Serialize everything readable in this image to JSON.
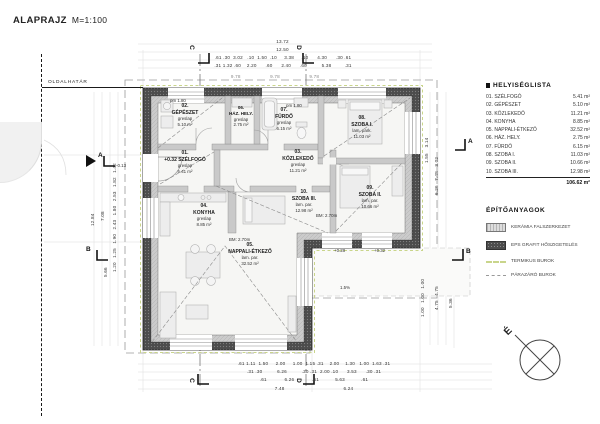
{
  "title": {
    "main": "ALAPRAJZ",
    "scale": "M=1:100"
  },
  "boundary": {
    "label": "OLDALHATÁR"
  },
  "rooms": [
    {
      "num": "01.",
      "level": "+0.32",
      "name": "SZÉLFOGÓ",
      "finish": "greslap",
      "area": "5.41 m²"
    },
    {
      "num": "02.",
      "name": "GÉPÉSZET",
      "finish": "greslap",
      "area": "5.10 m²"
    },
    {
      "num": "03.",
      "name": "KÖZLEKEDŐ",
      "finish": "greslap",
      "area": "11.21 m²"
    },
    {
      "num": "04.",
      "name": "KONYHA",
      "finish": "greslap",
      "area": "8.85 m²"
    },
    {
      "num": "05.",
      "name": "NAPPALI-ÉTKEZŐ",
      "finish": "lam. par.",
      "area": "32.52 m²"
    },
    {
      "num": "06.",
      "name": "HÁZ. HELY.",
      "finish": "greslap",
      "area": "2.75 m²"
    },
    {
      "num": "07.",
      "name": "FÜRDŐ",
      "finish": "greslap",
      "area": "6.15 m²"
    },
    {
      "num": "08.",
      "name": "SZOBA I.",
      "finish": "lam. park.",
      "area": "11.03 m²"
    },
    {
      "num": "09.",
      "name": "SZOBA II.",
      "finish": "lam. par.",
      "area": "10.66 m²"
    },
    {
      "num": "10.",
      "name": "SZOBA III.",
      "finish": "lam. par.",
      "area": "12.98 m²"
    }
  ],
  "room_list": {
    "title": "HELYISÉGLISTA",
    "items": [
      {
        "name": "01. SZÉLFOGÓ",
        "area": "5.41 m²"
      },
      {
        "name": "02. GÉPÉSZET",
        "area": "5.10 m²"
      },
      {
        "name": "03. KÖZLEKEDŐ",
        "area": "11.21 m²"
      },
      {
        "name": "04. KONYHA",
        "area": "8.85 m²"
      },
      {
        "name": "05. NAPPALI-ÉTKEZŐ",
        "area": "32.52 m²"
      },
      {
        "name": "06. HÁZ. HELY.",
        "area": "2.75 m²"
      },
      {
        "name": "07. FÜRDŐ",
        "area": "6.15 m²"
      },
      {
        "name": "08. SZOBA I.",
        "area": "11.03 m²"
      },
      {
        "name": "09. SZOBA II.",
        "area": "10.66 m²"
      },
      {
        "name": "10. SZOBA III.",
        "area": "12.98 m²"
      }
    ],
    "total": "106.62 m²"
  },
  "materials": {
    "title": "ÉPÍTŐANYAGOK",
    "items": [
      {
        "label": "KERÁMIA FALSZERKEZET"
      },
      {
        "label": "EPS GRAFIT HŐSZIGETELÉS"
      },
      {
        "label": "TERMIKUS BUROK"
      },
      {
        "label": "PÁRAZÁRÓ BUROK"
      }
    ]
  },
  "annotations": {
    "pm1": "pm 1.80",
    "pm2": "pm 1.80",
    "bm1": "BM: 2.70m",
    "bm2": "BM: 2.70m",
    "slope": "1.5%",
    "level_terrace1": "+0.28",
    "level_terrace2": "+0.32",
    "level_out": "-0.13"
  },
  "markers": {
    "a": "A",
    "b": "B",
    "c": "C",
    "d": "D"
  },
  "compass": {
    "north": "É"
  },
  "dims": {
    "top": {
      "total": "13.72",
      "sub": "12.50",
      "chain1": ".61 .30  3.02   .10  1.50  .10     3.38     .10      4.30      .30 .61",
      "chain2": ".31 1.32 .60    2.20      .60      2.40      .60          5.38         .31",
      "marks": "9.78                    9.78                    9.78"
    },
    "bottom": {
      "chain1": ".61 1.11  1.50     2.00     1.00  1.15 .31    2.00    1.30   1.00  1.63 .31",
      "chain2": ".31 .30          6.26          .30 .31  2.00 .10      3.53      .30 .31",
      "chain3": ".61            6.26            .61           5.63           .61",
      "chain4": "7.48                                        6.24"
    },
    "left": {
      "total": "12.84",
      "chain": "1.20   1.25   1.90   2.43   1.80   2.53   1.82   1.42",
      "mid": "7.08",
      "lower": "5.66"
    },
    "right": {
      "col1": "1.55    3.14",
      "col2": "6.26   7.48   3.02",
      "col3": "1.00   1.00   1.00",
      "col4": "4.75   4.75",
      "col5": "5.36"
    }
  },
  "colors": {
    "wall_eps": "#4c4c4c",
    "wall_ceramic": "#cccccc",
    "thermal": "#c9d58b",
    "vapor": "#999999"
  }
}
